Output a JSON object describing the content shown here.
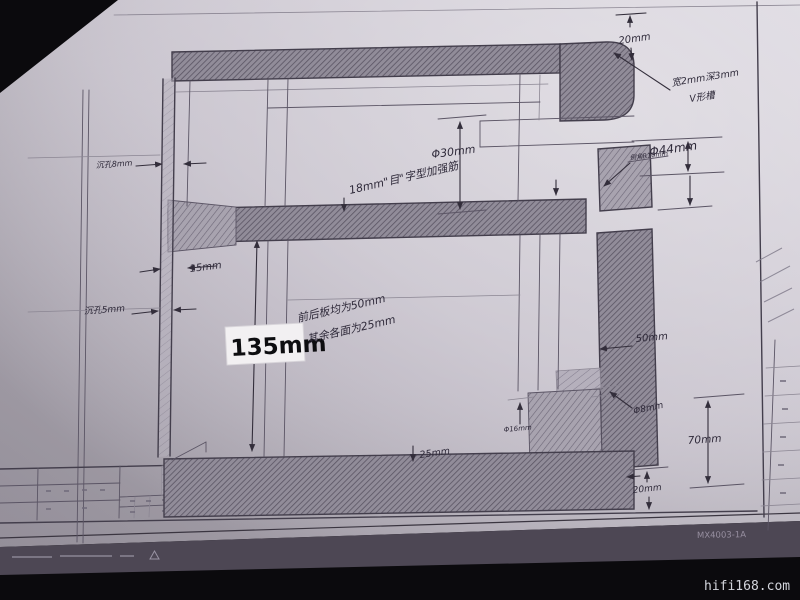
{
  "meta": {
    "watermark": "hifi168.com",
    "sheet_code": "MX4003-1A"
  },
  "colors": {
    "paper": "#c9c4ce",
    "pencil": "#433e4c",
    "marker_ink": "#0d0d10",
    "background": "#0b0a0d",
    "watermark_text": "#d3d5dc"
  },
  "labels": {
    "dim_20mm_top": "20mm",
    "v_groove_line1": "宽2mm深3mm",
    "v_groove_line2": "V形槽",
    "dim_phi30": "Φ30mm",
    "dim_phi44": "Φ44mm",
    "chamfer_note": "倒角R10mm",
    "rib_note": "18mm\"目\"字型加强筋",
    "counterbore_8": "沉孔8mm",
    "counterbore_5": "沉孔5mm",
    "dim_15mm": "15mm",
    "dim_135mm": "135mm",
    "panel_note_line1": "前后板均为50mm",
    "panel_note_line2": "其余各面为25mm",
    "dim_50mm": "50mm",
    "dim_phi16": "Φ16mm",
    "dim_phi8": "Φ8mm",
    "dim_70mm": "70mm",
    "dim_20mm_bottom": "20mm",
    "dim_25mm": "25mm"
  }
}
